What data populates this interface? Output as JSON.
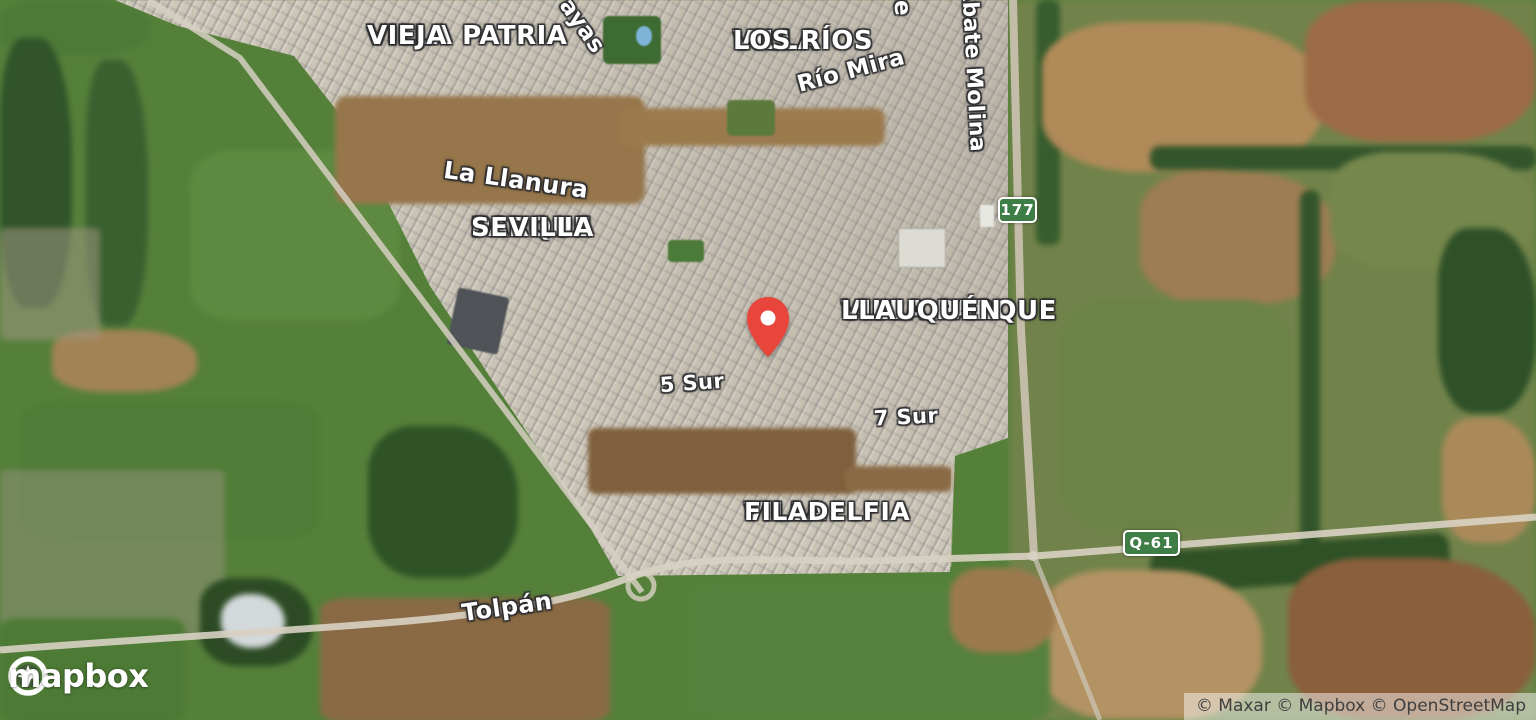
{
  "labels": {
    "villa_patria_vieja": {
      "line1": "VILLA PATRIA",
      "line2": "VIEJA"
    },
    "villa_los_rios": {
      "line1": "VILLA",
      "line2": "LOS RÍOS"
    },
    "villa_parque_llauquen": {
      "line1": "VILLA PARQUE",
      "line2": "LLAUQUÉN"
    },
    "parque_sevilla": {
      "line1": "PARQUE",
      "line2": "SEVILLA"
    },
    "villa_filadelfia": {
      "line1": "VILLA",
      "line2": "FILADELFIA"
    },
    "rio_mira": {
      "text": "Río Mira"
    },
    "abate_molina": {
      "text": "Abate Molina"
    },
    "la_llanura": {
      "text": "La Llanura"
    },
    "street_ayas": {
      "text": "ayas"
    },
    "street_partial_e": {
      "text": "e"
    },
    "sur_5": {
      "text": "5 Sur"
    },
    "sur_7": {
      "text": "7 Sur"
    },
    "tolpan": {
      "text": "Tolpán"
    }
  },
  "shields": {
    "route177": "177",
    "routeQ61": "Q-61"
  },
  "marker": {
    "description": "red map pin",
    "color": "#e8453c"
  },
  "colors": {
    "shield_green": "#3e7d46",
    "shield_text": "#ffffff",
    "label_text": "#ffffff"
  },
  "branding": {
    "logo": "mapbox",
    "attribution": "© Maxar © Mapbox © OpenStreetMap"
  }
}
